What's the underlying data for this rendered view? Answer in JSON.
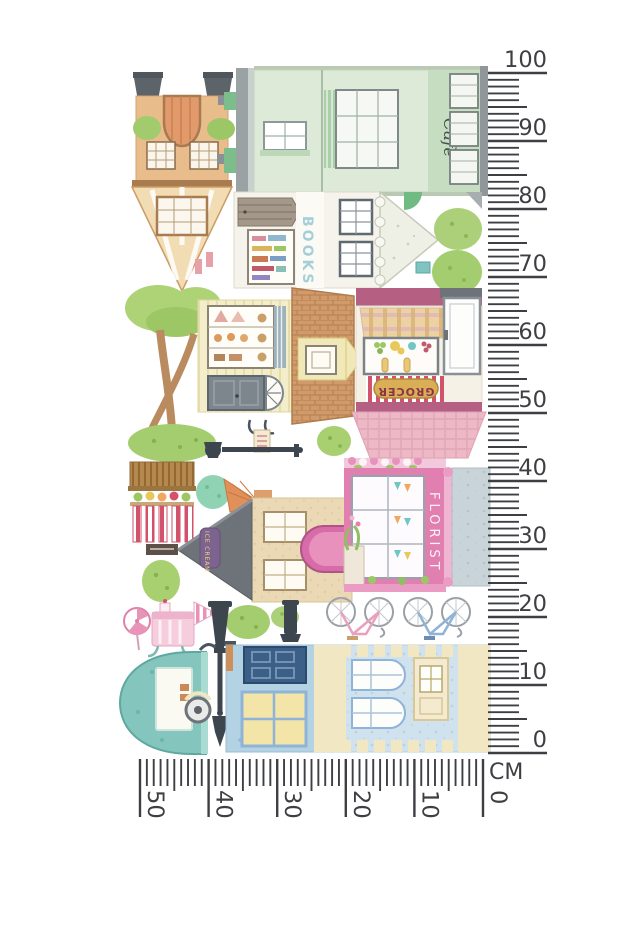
{
  "signs": {
    "cafe": "Café",
    "books": "BOOKS",
    "grocer": "GROCER",
    "florist": "FLORIST",
    "ice_cream": "ICE CREAM"
  },
  "rulers": {
    "ink_color": "#3e3f43",
    "vertical": {
      "unit": "CM",
      "min": 0,
      "max": 100,
      "major_step": 10,
      "minor_step": 1,
      "labels": [
        "100",
        "90",
        "80",
        "70",
        "60",
        "50",
        "40",
        "30",
        "20",
        "10",
        "0"
      ]
    },
    "horizontal": {
      "min": 0,
      "max": 50,
      "major_step": 10,
      "minor_step": 1,
      "labels": [
        "50",
        "40",
        "30",
        "20",
        "10",
        "0"
      ]
    }
  },
  "palette": {
    "mint": "#dcead7",
    "mint_dark": "#c7ddc2",
    "tan_wall": "#e9bd8b",
    "bakery_yellow": "#f3edca",
    "brick": "#d09a6b",
    "grocer_mauve": "#b55f83",
    "grocer_gold": "#d9ae57",
    "florist_pink": "#e17fb0",
    "ice_wall": "#ead9b4",
    "roof_grey": "#6d7378",
    "bush_green": "#a8cf70",
    "caravan_teal": "#84c5bd",
    "house_blue": "#b3d2e4",
    "school_blue": "#cfe2ee",
    "cream": "#f1e7c2",
    "lamp_dark": "#3d464e"
  }
}
